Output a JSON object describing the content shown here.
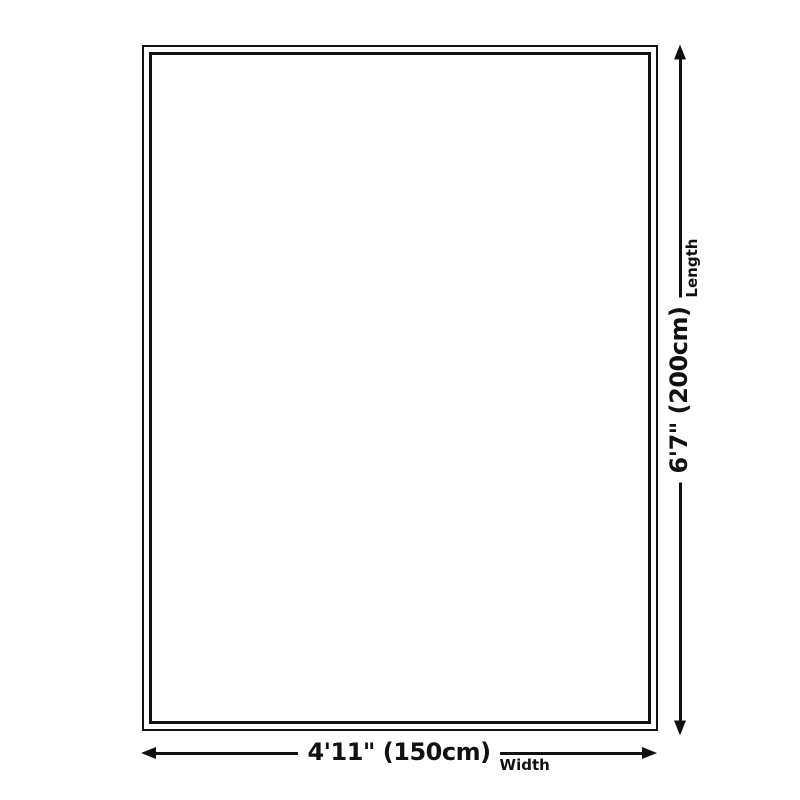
{
  "dimensions": {
    "length": {
      "value": "6'7\" (200cm)",
      "label": "Length"
    },
    "width": {
      "value": "4'11\" (150cm)",
      "label": "Width"
    }
  },
  "colors": {
    "line": "#111111",
    "background": "#ffffff"
  }
}
